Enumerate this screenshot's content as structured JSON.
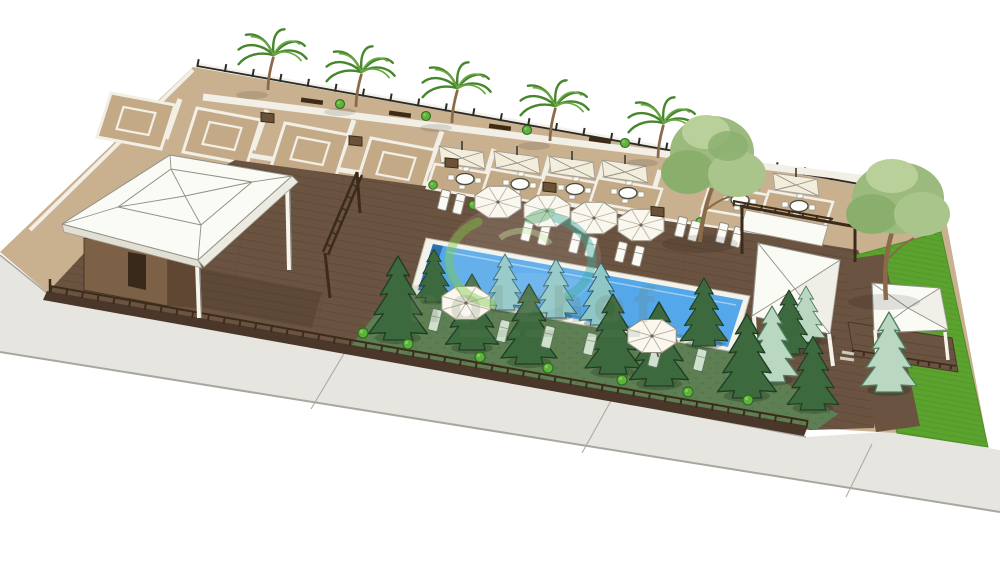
{
  "scene": {
    "type": "3d-architectural-rendering",
    "subject": "Aerial landscape design visualization of a resort pool terrace",
    "objects": [
      {
        "name": "paved-plaza-with-palm-walkway",
        "count": 1
      },
      {
        "name": "ornamental-tile-square",
        "count": 4
      },
      {
        "name": "palm-tree",
        "count": 5
      },
      {
        "name": "bench",
        "count": 4
      },
      {
        "name": "dining-umbrella-set",
        "count": 6
      },
      {
        "name": "pool-umbrella",
        "count": 6
      },
      {
        "name": "sun-lounger",
        "count": 18
      },
      {
        "name": "swimming-pool",
        "count": 1
      },
      {
        "name": "wooden-deck",
        "count": 1
      },
      {
        "name": "pavilion-with-hip-roof",
        "count": 1
      },
      {
        "name": "climbing-frame",
        "count": 1
      },
      {
        "name": "cabana-pergola",
        "count": 1
      },
      {
        "name": "lawn-gazebo",
        "count": 1
      },
      {
        "name": "conifer-tree",
        "count": 16
      },
      {
        "name": "deciduous-tree",
        "count": 2
      },
      {
        "name": "shrub",
        "count": 20
      },
      {
        "name": "lawn",
        "count": 1
      },
      {
        "name": "perimeter-fence",
        "count": 1
      },
      {
        "name": "sidewalk",
        "count": 1
      }
    ]
  },
  "watermark": {
    "text": "holzhof"
  },
  "palette": {
    "bg": "#ffffff",
    "plaza": "#c9b190",
    "tile-fill": "#c3a986",
    "white-line": "#f2efe6",
    "deck": "#6a5340",
    "deck-fascia": "#4a372a",
    "rail": "#3c2b1b",
    "garden": "#5d7f53",
    "lawn": "#5ba32e",
    "lawn-line": "#4c8f26",
    "pool-water": "#54a7e8",
    "pool-wall": "#2f6fae",
    "coping": "#f3f3ec",
    "roof": "#fbfbf6",
    "roof-line": "#8f8f88",
    "canopy": "#f3eedb",
    "sidewalk": "#e6e5e0",
    "sidewalk-line": "#a9a69e",
    "wall": "#7d6147",
    "wall-dark": "#5f4733",
    "door": "#38291b",
    "conifer": "#3c6a3e",
    "conifer-line": "#203d24",
    "spruce-blue": "#8fc6c6",
    "spruce-blue-line": "#2f5f68",
    "spruce-pale": "#b9d7c1",
    "spruce-pale-line": "#4f7d5e",
    "bush": "#5fb33c",
    "bush-line": "#2f6b22",
    "palm": "#47862c",
    "palm-light": "#6aa844",
    "trunk": "#8a6a48",
    "leafy-1": "#9cba7e",
    "leafy-2": "#8aaf6d",
    "leafy-3": "#aac58b",
    "leafy-4": "#b9d09b",
    "sage": "#cfe0cc",
    "sage-line": "#5c7258",
    "wm-green": "#7cc83e",
    "wm-teal": "#3aaa9a",
    "wm-leaf": "#52a46a",
    "wm-text": "#6e7f63"
  }
}
